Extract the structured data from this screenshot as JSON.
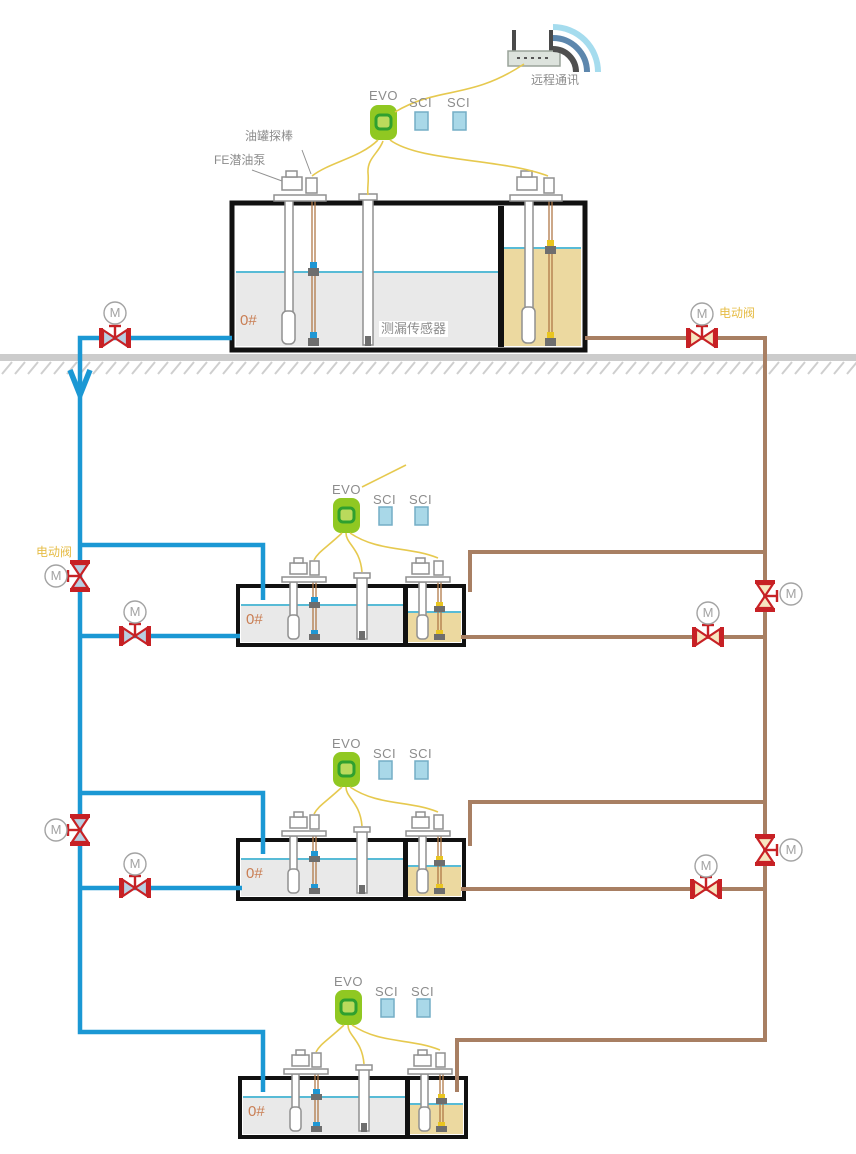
{
  "labels": {
    "remote_comm": "远程通讯",
    "evo": "EVO",
    "sci": "SCI",
    "tank_probe": "油罐探棒",
    "fe_pump": "FE潜油泵",
    "grade": "0#",
    "leak_sensor": "测漏传感器",
    "electric_valve": "电动阀",
    "motor": "M"
  },
  "colors": {
    "pipe_blue": "#1b98d4",
    "pipe_brown": "#a87f63",
    "wire_yellow": "#e6c94f",
    "valve_red": "#c72125",
    "valve_fill_blue": "#b8cfe2",
    "valve_fill_cream": "#f7e6c0",
    "evo_green": "#90c822",
    "evo_inner": "#2fa02f",
    "evo_inner_fill": "#bada5c",
    "sci_fill": "#a9d8e8",
    "sci_border": "#74aec6",
    "tank_border": "#111111",
    "diesel_gray": "#e9e9e9",
    "fuel_tan": "#ecd9a0",
    "liquid_cyan": "#58bbd6",
    "ground_gray": "#cccccc",
    "equip_gray": "#909090",
    "probe_brown": "#b07848",
    "float_gray": "#6e6e6e",
    "float_blue": "#1f97d4",
    "float_yellow": "#e9c520",
    "label_gray": "#8c8c8c",
    "grade_orange": "#c97e54",
    "motor_gray": "#a3a3a3",
    "valve_label_yellow": "#e6bc45",
    "arc_light": "#a5dcee",
    "arc_mid": "#5d87ad",
    "arc_dark": "#4f4f4f"
  }
}
